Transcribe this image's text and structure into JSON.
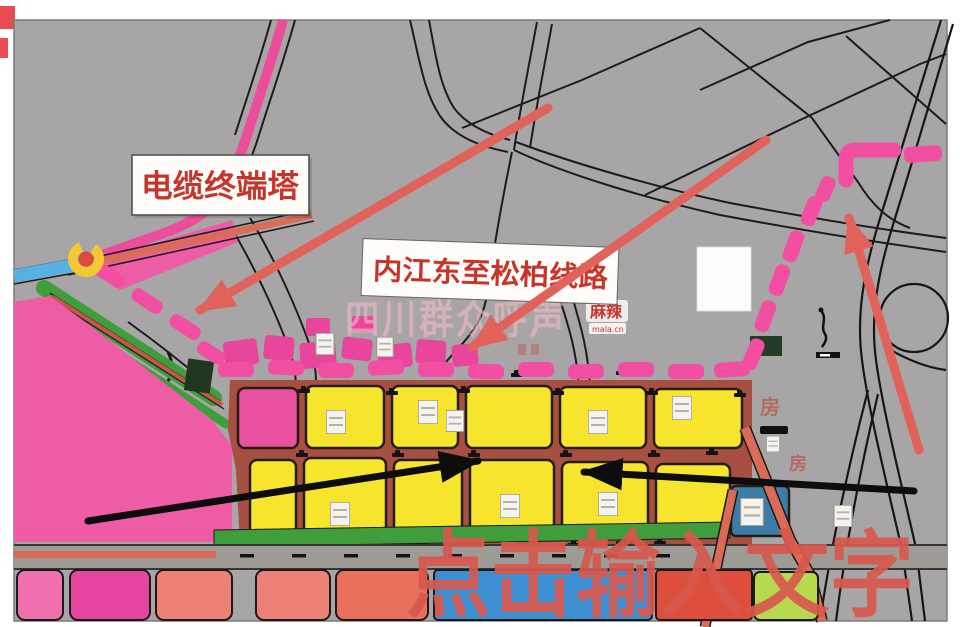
{
  "annotations": {
    "cable_tower_label": "电缆终端塔",
    "line_label": "内江东至松柏线路",
    "placeholder_text": "点击输入文字"
  },
  "watermark": {
    "text": "四川群众呼声",
    "logo": "麻辣",
    "logo_sub": "mala.cn"
  },
  "map_texts": {
    "house_1": "房",
    "house_2": "房"
  },
  "colors": {
    "route_pink": "#f24fa2",
    "zone_pink": "#ed5ca4",
    "patch_magenta": "#e8459c",
    "block_yellow": "#f6e52c",
    "red_arrow": "#e0625a",
    "black_arrow": "#0d0d0d",
    "label_red": "#c5352c",
    "big_text_red": "#d8584e",
    "green": "#3f9e3b",
    "blue_road": "#57b1e3",
    "parcel_blue": "#3e8ed2",
    "teal_parcel": "#3e7ca8",
    "chartreuse": "#b8d94d",
    "map_gray": "#a8a5a6"
  }
}
